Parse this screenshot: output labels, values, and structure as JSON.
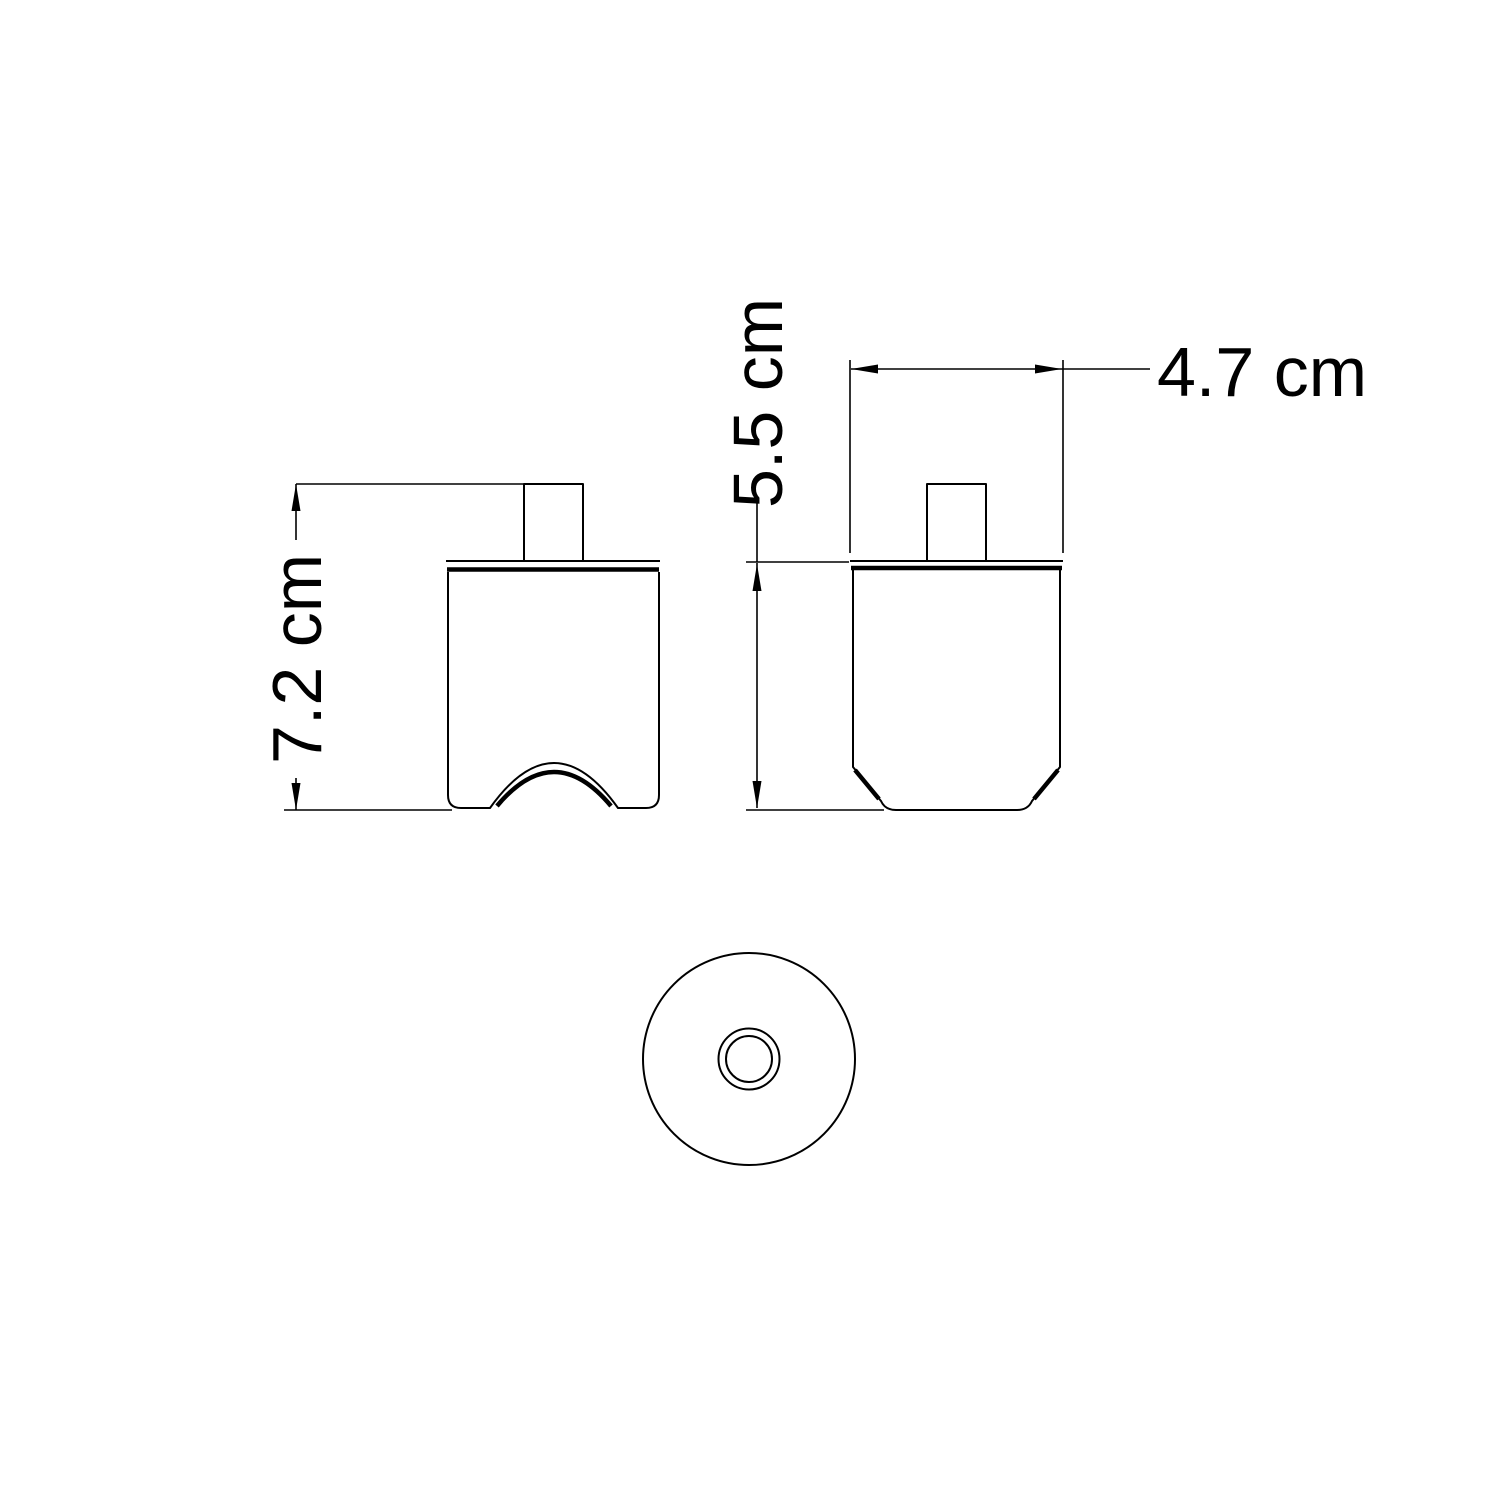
{
  "canvas": {
    "background_color": "#ffffff",
    "line_color": "#000000"
  },
  "dimensions": {
    "front_height": "7.2 cm",
    "side_body_height": "5.5 cm",
    "side_width": "4.7 cm"
  }
}
